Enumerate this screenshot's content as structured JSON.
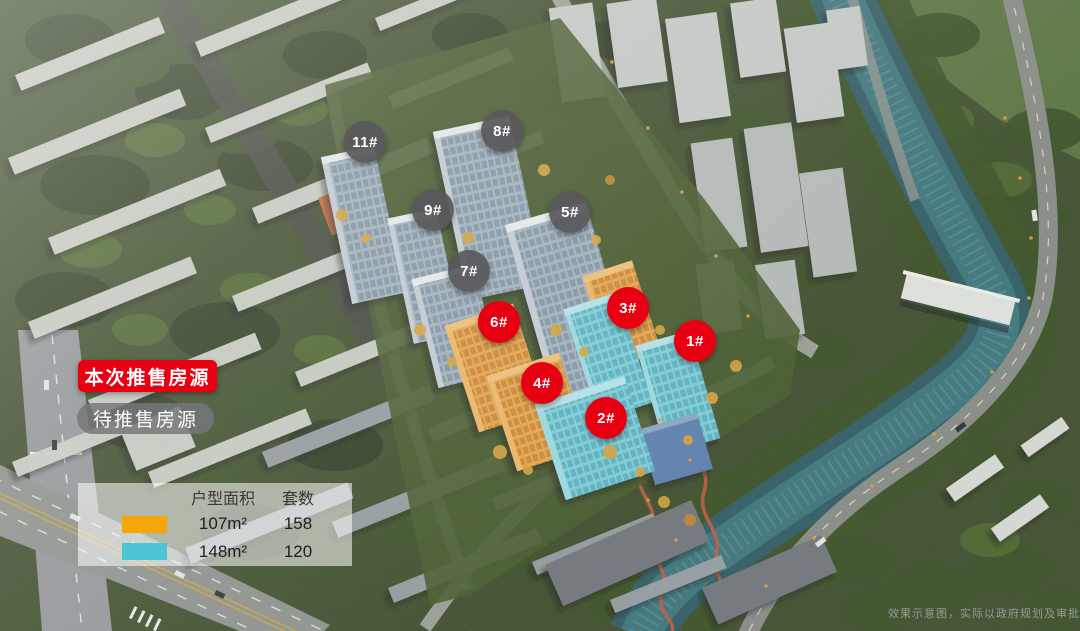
{
  "colors": {
    "on_sale_red": "#E60012",
    "upcoming_gray": "#58595B",
    "area_107_orange": "#F6A60B",
    "area_148_cyan": "#4FC4D6"
  },
  "badges": {
    "on_sale": "本次推售房源",
    "upcoming": "待推售房源"
  },
  "markers": [
    {
      "label": "11#",
      "status": "upcoming"
    },
    {
      "label": "8#",
      "status": "upcoming"
    },
    {
      "label": "9#",
      "status": "upcoming"
    },
    {
      "label": "5#",
      "status": "upcoming"
    },
    {
      "label": "7#",
      "status": "upcoming"
    },
    {
      "label": "6#",
      "status": "on_sale"
    },
    {
      "label": "3#",
      "status": "on_sale"
    },
    {
      "label": "1#",
      "status": "on_sale"
    },
    {
      "label": "4#",
      "status": "on_sale"
    },
    {
      "label": "2#",
      "status": "on_sale"
    }
  ],
  "unit_table": {
    "headers": {
      "area": "户型面积",
      "count": "套数"
    },
    "rows": [
      {
        "swatch_color": "#F6A60B",
        "area": "107m²",
        "count": "158"
      },
      {
        "swatch_color": "#4FC4D6",
        "area": "148m²",
        "count": "120"
      }
    ]
  },
  "disclaimer": "效果示意图，实际以政府规划及审批为准"
}
